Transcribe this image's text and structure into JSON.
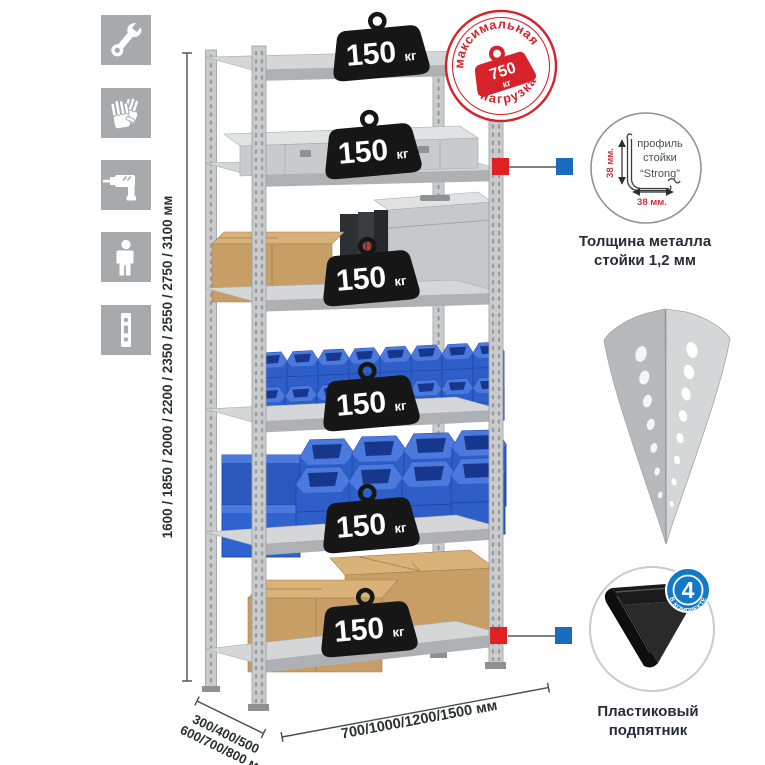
{
  "stamp": {
    "arc_top": "максимальная",
    "arc_bottom": "нагрузка",
    "value": "750",
    "unit": "кг"
  },
  "rack": {
    "shelves": [
      {
        "value": "150",
        "unit": "кг"
      },
      {
        "value": "150",
        "unit": "кг"
      },
      {
        "value": "150",
        "unit": "кг"
      },
      {
        "value": "150",
        "unit": "кг"
      },
      {
        "value": "150",
        "unit": "кг"
      },
      {
        "value": "150",
        "unit": "кг"
      }
    ]
  },
  "dimensions": {
    "height": "1600 / 1850 / 2000 / 2200 / 2350 / 2550 / 2750 / 3100 мм",
    "depth_line1": "300/400/500",
    "depth_line2": "600/700/800 мм",
    "width": "700/1000/1200/1500 мм"
  },
  "profile_callout": {
    "line1": "профиль",
    "line2": "стойки",
    "line3": "“Strong”",
    "dim_vertical": "38 мм.",
    "dim_horizontal": "38 мм.",
    "caption_line1": "Толщина металла",
    "caption_line2": "стойки 1,2 мм"
  },
  "foot_callout": {
    "badge_value": "4",
    "badge_label": "в комплекте",
    "caption_line1": "Пластиковый",
    "caption_line2": "подпятник"
  },
  "sidebar": {
    "icons": [
      {
        "name": "wrench"
      },
      {
        "name": "work-gloves"
      },
      {
        "name": "drill"
      },
      {
        "name": "person"
      },
      {
        "name": "rack-post"
      }
    ]
  },
  "colors": {
    "stamp_red": "#d6232b",
    "connector_red": "#e02224",
    "connector_blue": "#1b6cc0",
    "badge_blue": "#1278c8",
    "bin_blue": "#2e5fc8",
    "metal_gray": "#c9cbcd",
    "cardboard_tan": "#c79e66",
    "weight_black": "#161616",
    "icon_tile_gray": "#a7aaac"
  }
}
